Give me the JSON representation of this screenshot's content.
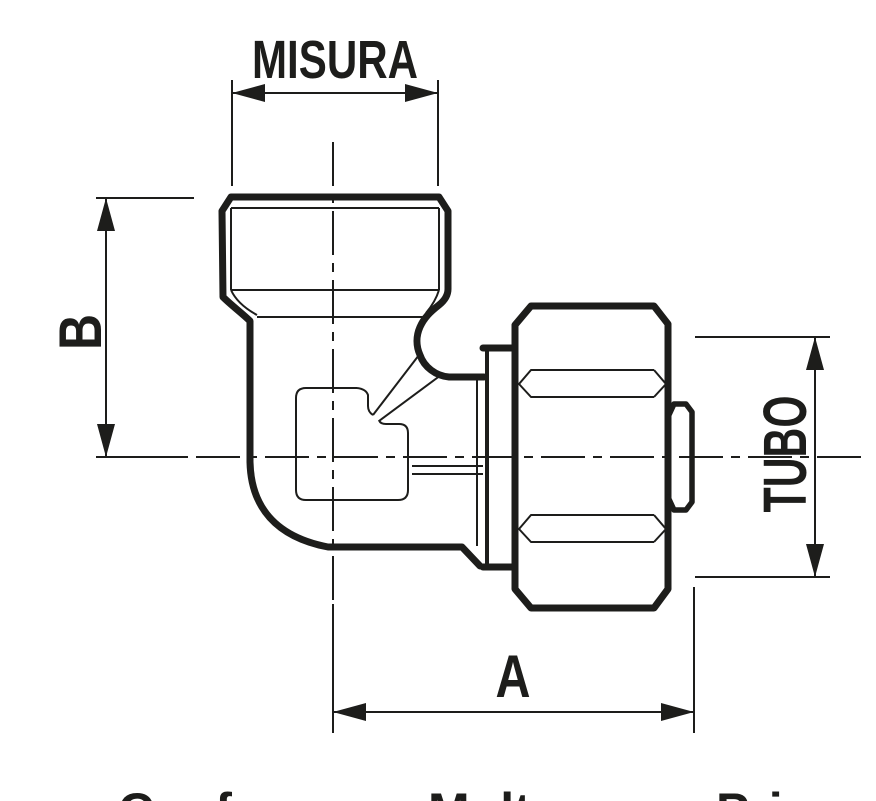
{
  "drawing": {
    "kind": "technical line drawing — 90-degree elbow compression fitting, side section view",
    "ink_color": "#1d1d1b",
    "background_color": "#ffffff",
    "labels": {
      "misura": "MISURA",
      "b": "B",
      "tubo": "TUBO",
      "a": "A"
    },
    "dimensions": [
      {
        "name": "MISURA",
        "orientation": "horizontal",
        "position": "top",
        "measures": "thread width of vertical male port"
      },
      {
        "name": "B",
        "orientation": "vertical",
        "position": "left",
        "measures": "top face to horizontal port axis"
      },
      {
        "name": "TUBO",
        "orientation": "vertical",
        "position": "right",
        "measures": "pipe / nut diameter"
      },
      {
        "name": "A",
        "orientation": "horizontal",
        "position": "bottom",
        "measures": "vertical port axis to right end"
      }
    ],
    "bottom_cropped_text": {
      "col1": "Conf",
      "col2": "Mult",
      "col3": "Pri"
    }
  }
}
